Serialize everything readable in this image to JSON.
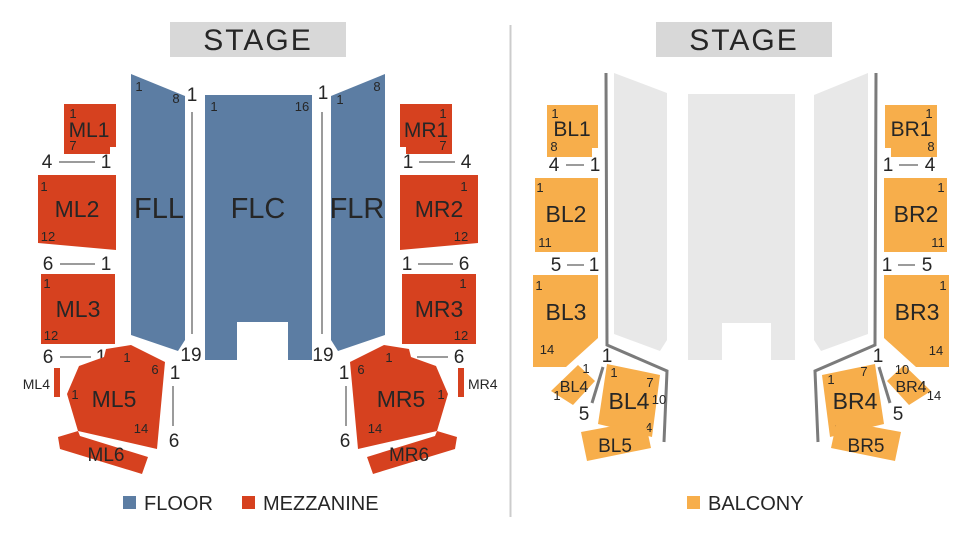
{
  "left": {
    "stage_label": "STAGE",
    "legend": [
      {
        "label": "FLOOR",
        "color": "#5C7DA3"
      },
      {
        "label": "MEZZANINE",
        "color": "#D6411F"
      }
    ],
    "sections": {
      "FLL": {
        "label": "FLL",
        "tl": "1",
        "tr": "8"
      },
      "FLC": {
        "label": "FLC",
        "tl": "1",
        "tr": "16"
      },
      "FLR": {
        "label": "FLR",
        "tl": "1",
        "tr": "8"
      },
      "ML1": {
        "label": "ML1",
        "tl": "1",
        "bl": "7"
      },
      "ML2": {
        "label": "ML2",
        "tl": "1",
        "bl": "12"
      },
      "ML3": {
        "label": "ML3",
        "tl": "1",
        "bl": "12"
      },
      "ML4": {
        "label": "ML4"
      },
      "ML5": {
        "label": "ML5",
        "top": "1",
        "tr": "6",
        "left": "1",
        "bottom": "14"
      },
      "ML6": {
        "label": "ML6"
      },
      "MR1": {
        "label": "MR1",
        "tr": "1",
        "br": "7"
      },
      "MR2": {
        "label": "MR2",
        "tr": "1",
        "br": "12"
      },
      "MR3": {
        "label": "MR3",
        "tr": "1",
        "br": "12"
      },
      "MR4": {
        "label": "MR4"
      },
      "MR5": {
        "label": "MR5",
        "top": "1",
        "tl": "6",
        "right": "1",
        "bottom": "14"
      },
      "MR6": {
        "label": "MR6"
      }
    },
    "aisles": {
      "left": {
        "top": "1",
        "bottom": "19"
      },
      "right": {
        "top": "1",
        "bottom": "19"
      },
      "ml5": {
        "top": "1",
        "bottom": "6"
      },
      "mr5": {
        "top": "1",
        "bottom": "6"
      }
    },
    "rows": {
      "ml1": {
        "a": "4",
        "b": "1"
      },
      "ml2": {
        "a": "6",
        "b": "1"
      },
      "ml3": {
        "a": "6",
        "b": "1"
      },
      "mr1": {
        "a": "1",
        "b": "4"
      },
      "mr2": {
        "a": "1",
        "b": "6"
      },
      "mr3": {
        "a": "1",
        "b": "6"
      }
    }
  },
  "right": {
    "stage_label": "STAGE",
    "legend": [
      {
        "label": "BALCONY",
        "color": "#F7AE4B"
      }
    ],
    "sections": {
      "BL1": {
        "label": "BL1",
        "tl": "1",
        "bl": "8"
      },
      "BL2": {
        "label": "BL2",
        "tl": "1",
        "bl": "11"
      },
      "BL3": {
        "label": "BL3",
        "tl": "1",
        "bl": "14"
      },
      "BL4s": {
        "label": "BL4",
        "top": "1",
        "left": "1",
        "below": "5"
      },
      "BL4": {
        "label": "BL4",
        "tl": "1",
        "tr": "7",
        "right": "10",
        "br": "14",
        "bend": "1"
      },
      "BL5": {
        "label": "BL5"
      },
      "BR1": {
        "label": "BR1",
        "tr": "1",
        "br": "8"
      },
      "BR2": {
        "label": "BR2",
        "tr": "1",
        "br": "11"
      },
      "BR3": {
        "label": "BR3",
        "tr": "1",
        "br": "14"
      },
      "BR4": {
        "label": "BR4",
        "tl": "1",
        "tr": "7",
        "bl": "1",
        "bend": "1"
      },
      "BR4s": {
        "label": "BR4",
        "top": "10",
        "right": "14",
        "below": "5"
      },
      "BR5": {
        "label": "BR5"
      }
    },
    "rows": {
      "bl1": {
        "a": "4",
        "b": "1"
      },
      "bl2": {
        "a": "5",
        "b": "1"
      },
      "br1": {
        "a": "1",
        "b": "4"
      },
      "br2": {
        "a": "1",
        "b": "5"
      }
    }
  },
  "colors": {
    "floor": "#5C7DA3",
    "mezzanine": "#D6411F",
    "balcony": "#F7AE4B",
    "ghost_floor": "#E8E8E8",
    "stage_bg": "#D8D8D8",
    "rail": "#7B7B7B",
    "line": "#9B9B9B",
    "divider": "#CCCCCC",
    "text": "#262626"
  }
}
